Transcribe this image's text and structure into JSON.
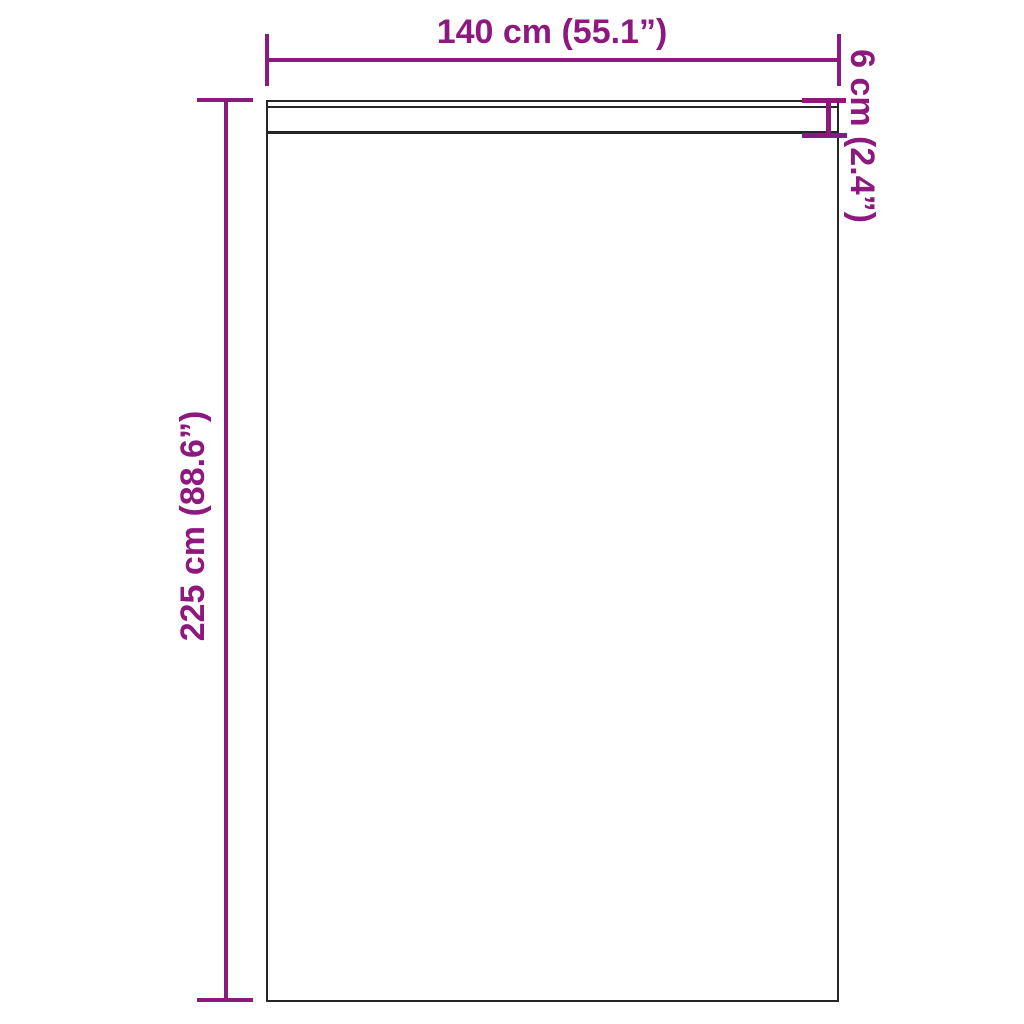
{
  "diagram": {
    "type": "product-dimension-drawing",
    "labels": {
      "width": "140 cm (55.1”)",
      "height": "225 cm (88.6”)",
      "header_band": "6 cm (2.4”)"
    },
    "measurements": {
      "width_cm": 140,
      "width_in": 55.1,
      "height_cm": 225,
      "height_in": 88.6,
      "header_band_cm": 6,
      "header_band_in": 2.4
    },
    "colors": {
      "dimension_accent": "#8d187e",
      "outline": "#262626",
      "background": "#ffffff"
    }
  }
}
